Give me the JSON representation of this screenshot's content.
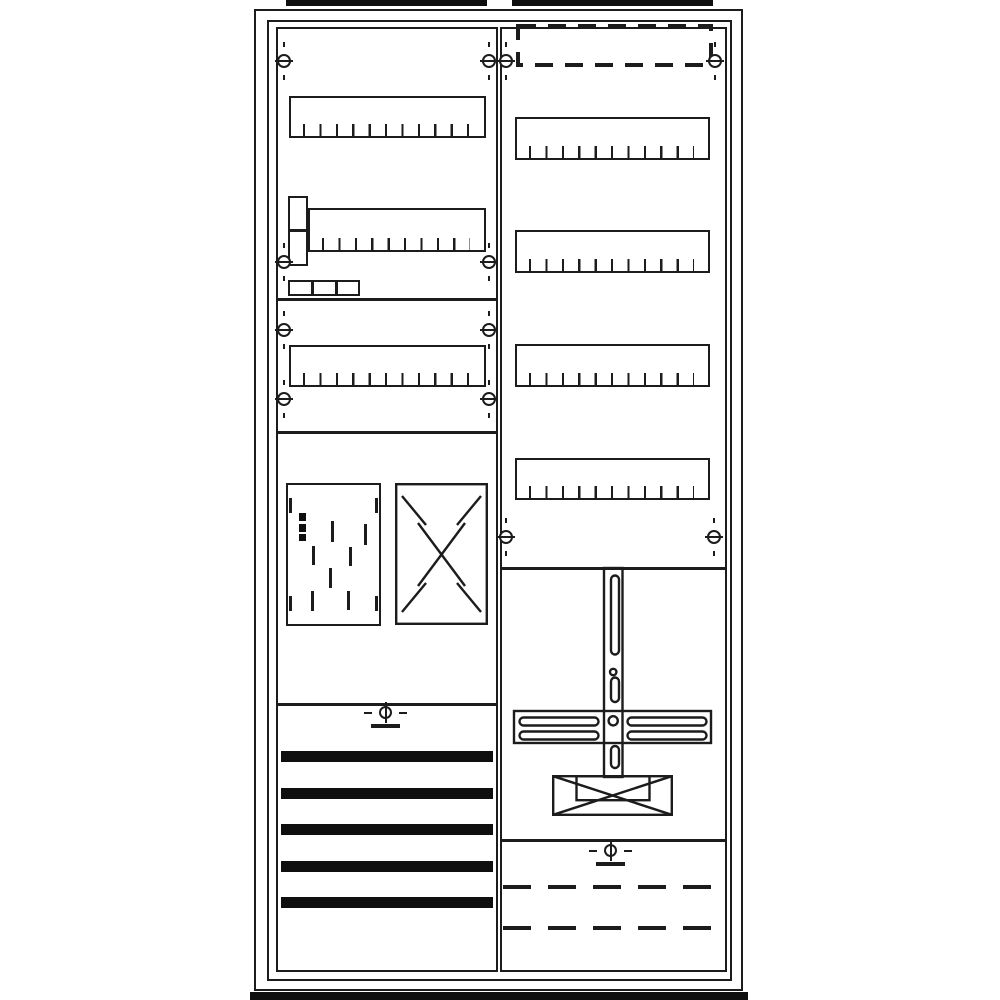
{
  "meta": {
    "type": "technical-line-drawing",
    "subject": "two-field electrical meter distribution cabinet, front view",
    "visible_text": "none"
  },
  "colors": {
    "background": "#ffffff",
    "line": "#1c1c1c",
    "solid_fill": "#0f0f0f"
  },
  "figure": {
    "modules_per_din_row": 12,
    "left_field": {
      "screws": [
        [
          284,
          61
        ],
        [
          489,
          61
        ],
        [
          284,
          262
        ],
        [
          489,
          262
        ],
        [
          284,
          330
        ],
        [
          489,
          330
        ],
        [
          284,
          399
        ],
        [
          489,
          399
        ]
      ],
      "din_rows": [
        {
          "x": 289,
          "y": 96,
          "w": 197,
          "h": 42
        },
        {
          "x": 308,
          "y": 208,
          "w": 178,
          "h": 44
        },
        {
          "x": 289,
          "y": 345,
          "w": 197,
          "h": 42
        }
      ],
      "busbar": {
        "x": 281,
        "w": 212,
        "h": 11,
        "y_positions": [
          751,
          788,
          824,
          861,
          897
        ]
      },
      "meter_window": {
        "corner_marks": [
          [
            289,
            498
          ],
          [
            375,
            498
          ],
          [
            289,
            596
          ],
          [
            375,
            596
          ]
        ],
        "barcode_blocks": [
          [
            299,
            513,
            8
          ],
          [
            299,
            524,
            8
          ],
          [
            299,
            534,
            7
          ]
        ],
        "pattern_dashes": [
          [
            331,
            521,
            21
          ],
          [
            364,
            524,
            21
          ],
          [
            312,
            546,
            19
          ],
          [
            349,
            547,
            19
          ],
          [
            329,
            568,
            20
          ],
          [
            311,
            591,
            20
          ],
          [
            347,
            591,
            19
          ]
        ]
      }
    },
    "right_field": {
      "screws": [
        [
          506,
          61
        ],
        [
          715,
          61
        ],
        [
          506,
          537
        ],
        [
          714,
          537
        ]
      ],
      "din_rows": [
        {
          "x": 515,
          "y": 117,
          "w": 195,
          "h": 43
        },
        {
          "x": 515,
          "y": 230,
          "w": 195,
          "h": 43
        },
        {
          "x": 515,
          "y": 344,
          "w": 195,
          "h": 43
        },
        {
          "x": 515,
          "y": 458,
          "w": 195,
          "h": 42
        }
      ]
    }
  }
}
